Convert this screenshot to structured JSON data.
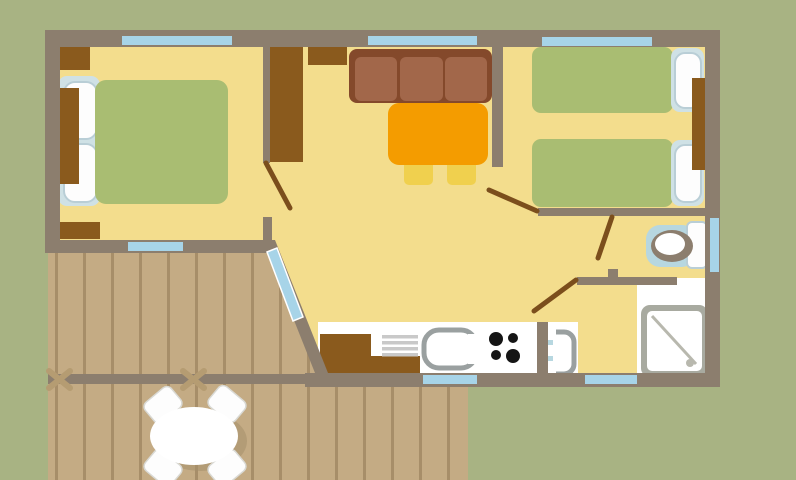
{
  "title": "Mobile home floor plan",
  "palette": {
    "olive": "#a8b383",
    "wall": "#8c7e6e",
    "floor": "#f3dd8d",
    "window": "#a7d4e8",
    "furniture": "#8a5a1d",
    "bed": "#a9bd72",
    "pillowZone": "#cfe1e5",
    "pillowWhite": "#fdfdfd",
    "pillowEdge": "#b9ced6",
    "sofaFrame": "#84492b",
    "sofaCushion": "#a2674a",
    "table": "#f49c00",
    "chair": "#f0d04e",
    "door": "#7b4e1c",
    "white": "#ffffff",
    "toiletMat": "#b7d7e0",
    "showerFrame": "#a8aaa0",
    "showerDetail": "#b8b8ae",
    "sinkGray": "#9aa0a0",
    "drainer": "#c9c9c9",
    "burner": "#151515",
    "deck": "#c4ab84",
    "plank": "#a78e69",
    "deckCross": "#b59c72",
    "shadow": "#a5906c",
    "chairEdge": "#d9d9d4"
  },
  "rooms": {
    "bedroom_double": {
      "label": "Double bedroom"
    },
    "bedroom_twin": {
      "label": "Twin bedroom"
    },
    "living": {
      "label": "Living area"
    },
    "kitchen": {
      "label": "Kitchenette"
    },
    "bathroom": {
      "label": "Shower room"
    },
    "wc": {
      "label": "WC"
    },
    "terrace": {
      "label": "Wooden terrace"
    }
  },
  "furniture_icons": {
    "double_bed": "double-bed-icon",
    "twin_beds": "twin-bed-icons",
    "sofa": "sofa-icon",
    "dining_table": "dining-table-icon",
    "wardrobe": "wardrobe-icon",
    "kitchen_counter": "kitchen-counter-icon",
    "toilet": "toilet-icon",
    "shower": "shower-icon",
    "washbasin": "washbasin-icon",
    "patio_table": "patio-table-icon"
  }
}
